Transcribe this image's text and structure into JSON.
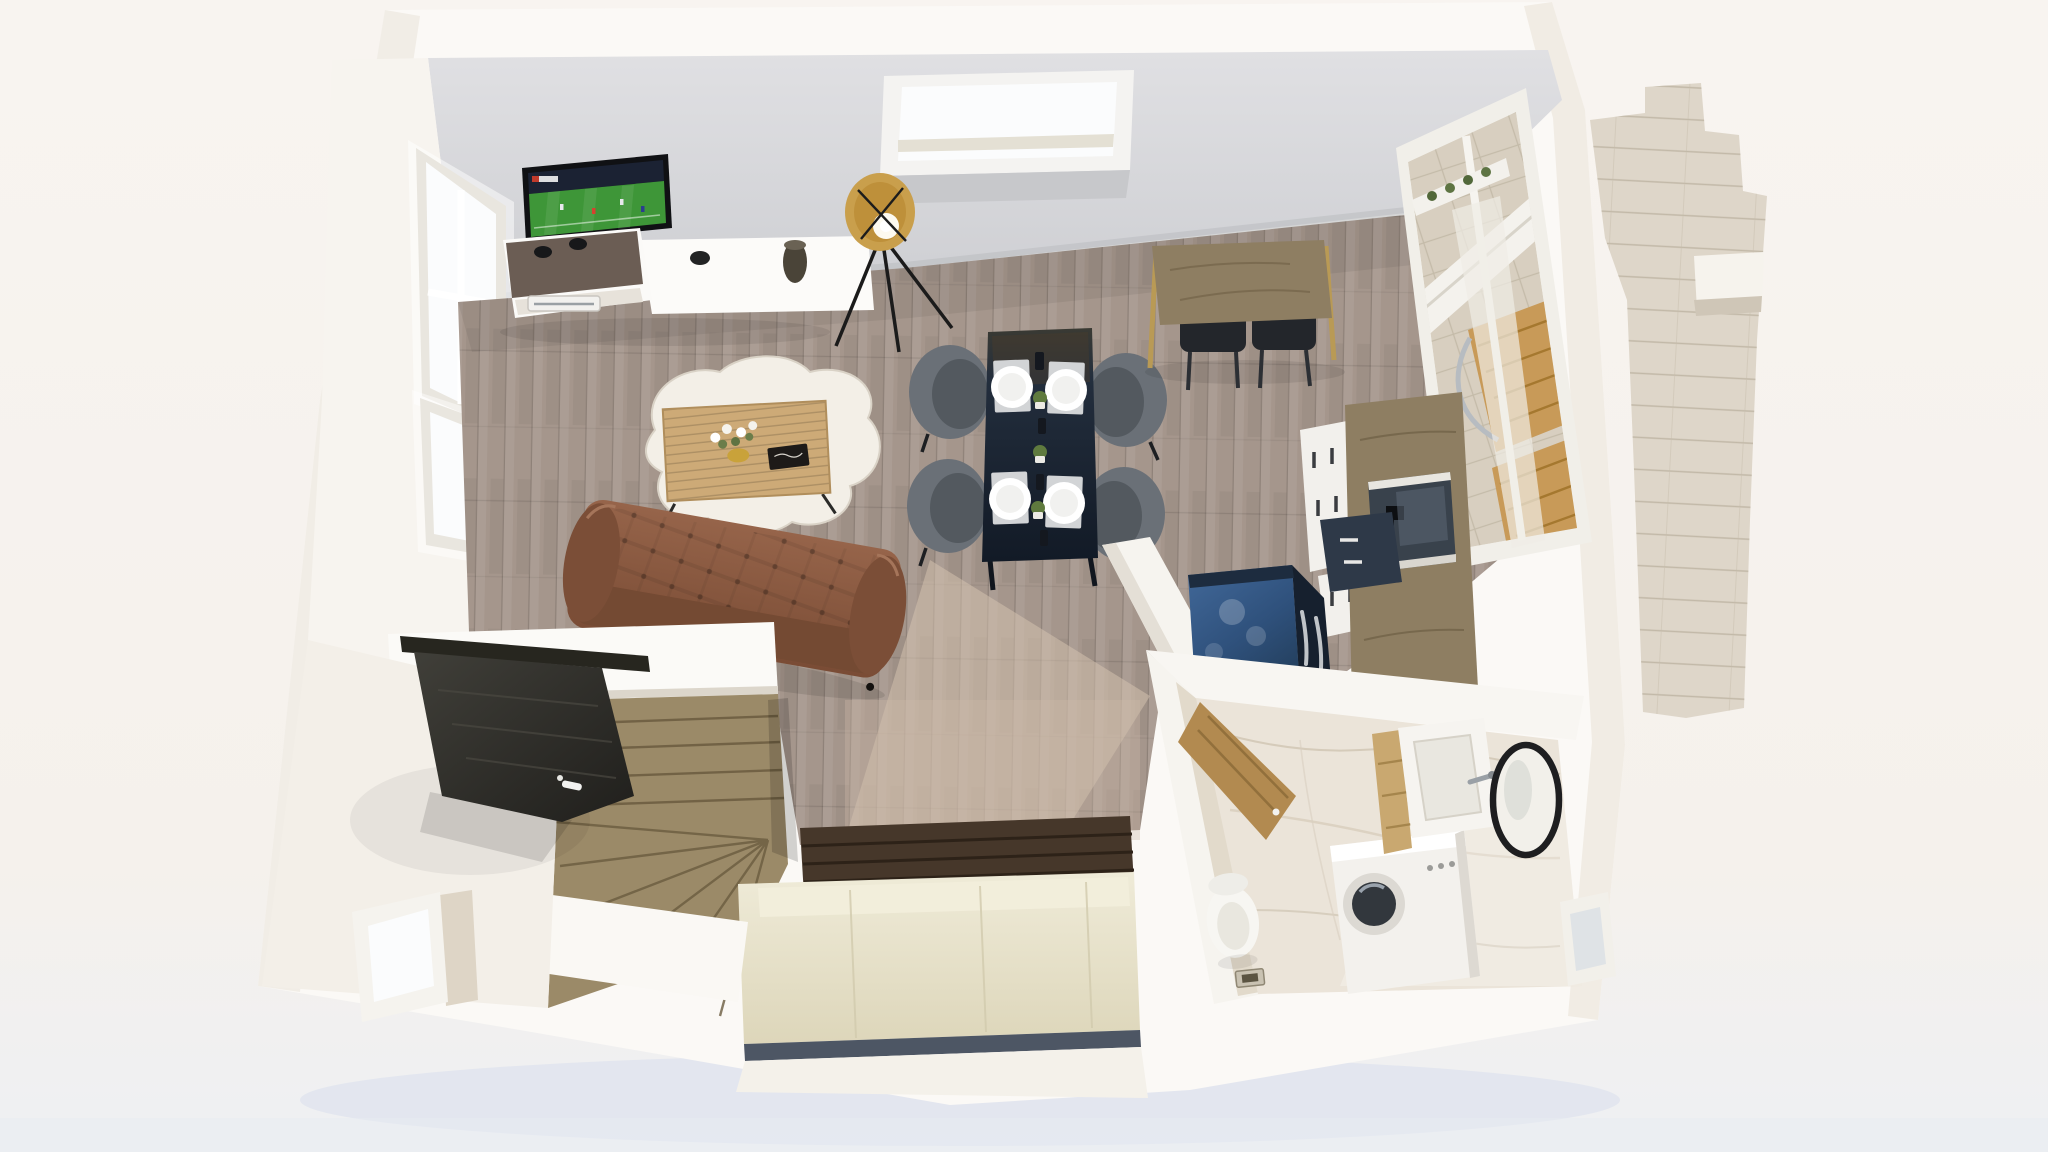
{
  "scene": {
    "title": "3D dollhouse floor-plan render of an attic studio apartment",
    "view": "top-down cutaway with perspective tilt",
    "style": "photorealistic architectural visualization",
    "lighting": "daylight through left windows, right balcony window and roof skylight"
  },
  "palette": {
    "background": "#f6f2ed",
    "ground_shadow": "#d8dfec",
    "wall_white": "#fbf9f6",
    "wall_shade": "#efeae2",
    "ceiling": "#d9d9dc",
    "floor_wood": "#a5968c",
    "sun_pool": "#d8c6b2",
    "entry_floor": "#f3efe8",
    "sofa": "#8a5a41",
    "sofa_dark": "#744a33",
    "rug": "#f3efe7",
    "coffee_table": "#cdaa77",
    "dining_table": "#1c2634",
    "chair": "#6a7077",
    "chair_seat": "#53595f",
    "plate": "#ffffff",
    "placemat": "#d2d4d6",
    "bar_table": "#8e7e62",
    "stool": "#23262b",
    "kitchen_wood": "#8e7e62",
    "cabinet_white": "#f2f0ec",
    "cabinet_dark": "#2e3948",
    "oven_glass": "#39424c",
    "fridge": "#33587f",
    "fridge_side": "#16202e",
    "marble": "#ebe4d9",
    "marble_wall": "#e2dacb",
    "fixture_white": "#f6f4f0",
    "mirror_rim": "#1e1e20",
    "bed": "#e7e2c8",
    "headboard": "#46372a",
    "stairs": "#9b8a68",
    "door_dark": "#31302c",
    "lamp_gold": "#c99f4c",
    "tv_frame": "#101114",
    "pitch_green": "#3e9638",
    "stadium_dark": "#1b2233",
    "window_glow": "#fbfcfd",
    "balcony_stone": "#d8cfc0",
    "deck_wood": "#c89a58",
    "stone_wall": "#ded6c9",
    "bed_shadow_band": "#3a4454"
  },
  "rooms": [
    {
      "name": "living-room",
      "floor": "grey oak planks",
      "items": [
        "wall-mounted TV playing a football match",
        "white TV sideboard with smoked-glass top",
        "game console with two controllers",
        "black vase",
        "gold tripod floor lamp",
        "brown tufted leather sofa",
        "light oak slatted coffee table",
        "white flower bouquet",
        "black book",
        "white sheepskin rug"
      ]
    },
    {
      "name": "dining-area",
      "items": [
        "dark navy dining table set for four",
        "four grey shell chairs",
        "four white plates on grey placemats",
        "small potted plants and candles on runner"
      ]
    },
    {
      "name": "kitchen",
      "items": [
        "wooden bar table with two charcoal stools",
        "white drawer cabinets with dark handles",
        "tall wood cabinet with built-in oven",
        "navy-blue retro refrigerator with chrome handles",
        "wood worktop",
        "white half-height partition"
      ]
    },
    {
      "name": "bathroom",
      "floor": "white marble",
      "items": [
        "white toilet",
        "floor drain",
        "washing machine with round glass door",
        "square white basin on wood vanity",
        "round black-framed mirror",
        "small window",
        "open wooden door"
      ]
    },
    {
      "name": "sleeping-nook",
      "items": [
        "cream double bed",
        "dark wood slatted headboard",
        "white platform surround"
      ]
    },
    {
      "name": "entry",
      "items": [
        "dark wood front door with white handle",
        "wooden winder staircase",
        "small window in gable wall"
      ]
    },
    {
      "name": "exterior",
      "items": [
        "roof skylight",
        "two glowing windows in left wall",
        "balcony window with wooden deck chairs and stone tiled wall",
        "stepped stone gable of neighbouring wall"
      ]
    }
  ]
}
